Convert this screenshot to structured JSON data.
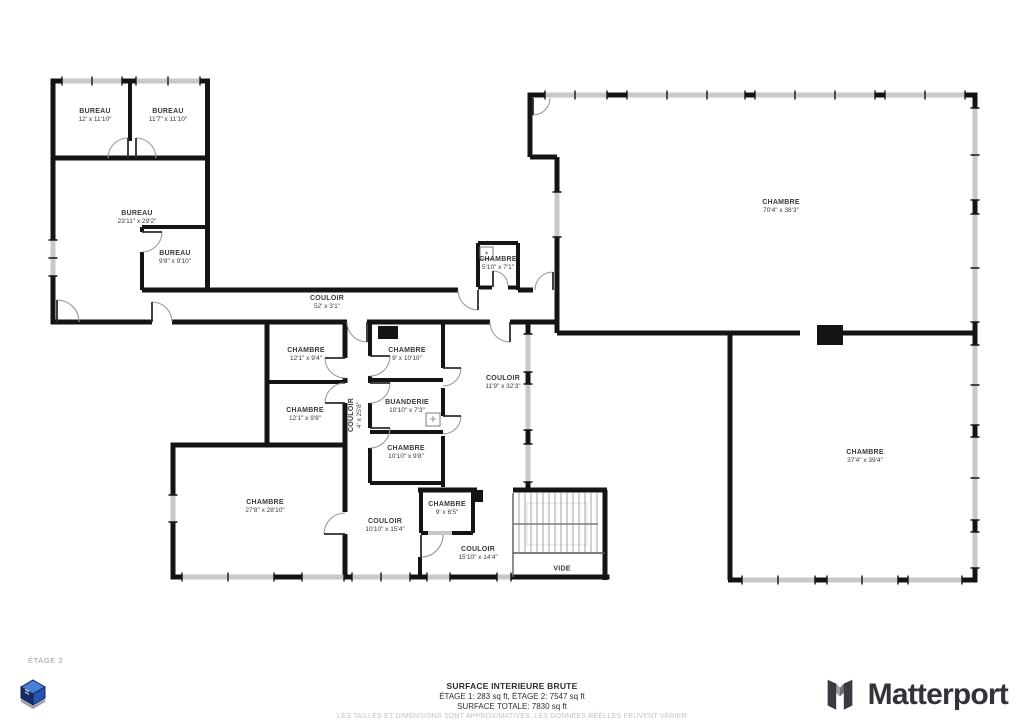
{
  "floor_tag": "ÉTAGE 2",
  "rooms": [
    {
      "name": "BUREAU",
      "dims": "12' x 11'10\""
    },
    {
      "name": "BUREAU",
      "dims": "11'7\" x 11'10\""
    },
    {
      "name": "BUREAU",
      "dims": "23'11\" x 29'2\""
    },
    {
      "name": "BUREAU",
      "dims": "9'8\" x 9'10\""
    },
    {
      "name": "COULOIR",
      "dims": "52' x 3'1\""
    },
    {
      "name": "CHAMBRE",
      "dims": "5'10\" x 7'1\""
    },
    {
      "name": "CHAMBRE",
      "dims": "70'4\" x 38'3\""
    },
    {
      "name": "CHAMBRE",
      "dims": "12'1\" x 9'4\""
    },
    {
      "name": "CHAMBRE",
      "dims": "9' x 10'10\""
    },
    {
      "name": "CHAMBRE",
      "dims": "12'1\" x 9'8\""
    },
    {
      "name": "BUANDERIE",
      "dims": "10'10\" x 7'3\""
    },
    {
      "name": "COULOIR",
      "dims": "4' x 25'8\""
    },
    {
      "name": "CHAMBRE",
      "dims": "10'10\" x 9'8\""
    },
    {
      "name": "COULOIR",
      "dims": "11'9\" x 32'3\""
    },
    {
      "name": "CHAMBRE",
      "dims": "27'8\" x 28'10\""
    },
    {
      "name": "COULOIR",
      "dims": "10'10\" x 15'4\""
    },
    {
      "name": "CHAMBRE",
      "dims": "9' x 6'5\""
    },
    {
      "name": "COULOIR",
      "dims": "15'10\" x 14'4\""
    },
    {
      "name": "VIDE",
      "dims": ""
    },
    {
      "name": "CHAMBRE",
      "dims": "37'4\" x 39'4\""
    }
  ],
  "summary": {
    "line1": "SURFACE INTERIEURE BRUTE",
    "line2": "ÉTAGE 1: 283 sq ft, ÉTAGE 2: 7547 sq ft",
    "line3": "SURFACE TOTALE: 7830 sq ft",
    "disclaimer": "LES TAILLES ET DIMENSIONS SONT APPROXIMATIVES, LES DONNÉES RÉELLES PEUVENT VARIER"
  },
  "brand": {
    "name": "Matterport"
  },
  "colors": {
    "wall": "#141414",
    "window": "#c9c9c9",
    "accent_blue": "#2a52b0",
    "brand_dark": "#32323a"
  }
}
